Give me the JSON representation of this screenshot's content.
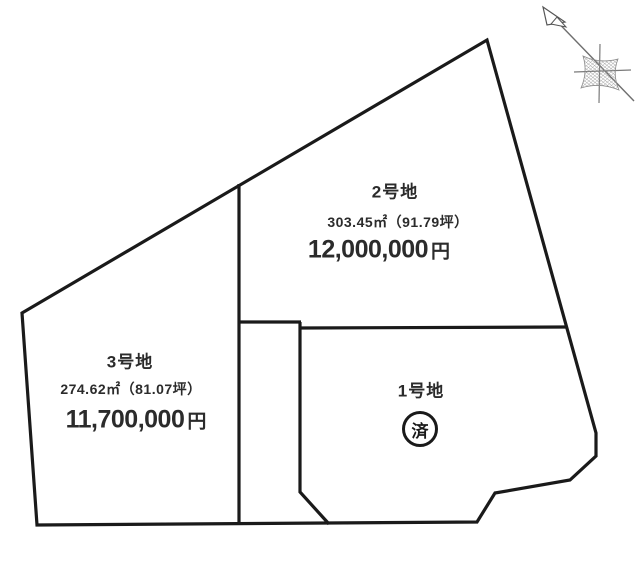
{
  "plots": {
    "plot1": {
      "name": "1号地",
      "status": "済"
    },
    "plot2": {
      "name": "2号地",
      "area": "303.45㎡（91.79坪）",
      "price": "12,000,000",
      "currency": "円"
    },
    "plot3": {
      "name": "3号地",
      "area": "274.62㎡（81.07坪）",
      "price": "11,700,000",
      "currency": "円"
    }
  },
  "icons": {
    "compass": "north-arrow-icon",
    "sold_mark": "circled-sold-badge"
  },
  "colors": {
    "boundary_line": "#1a1a1a",
    "text": "#2b2b2b",
    "compass_gray": "#7a7a7a",
    "background": "#ffffff"
  }
}
